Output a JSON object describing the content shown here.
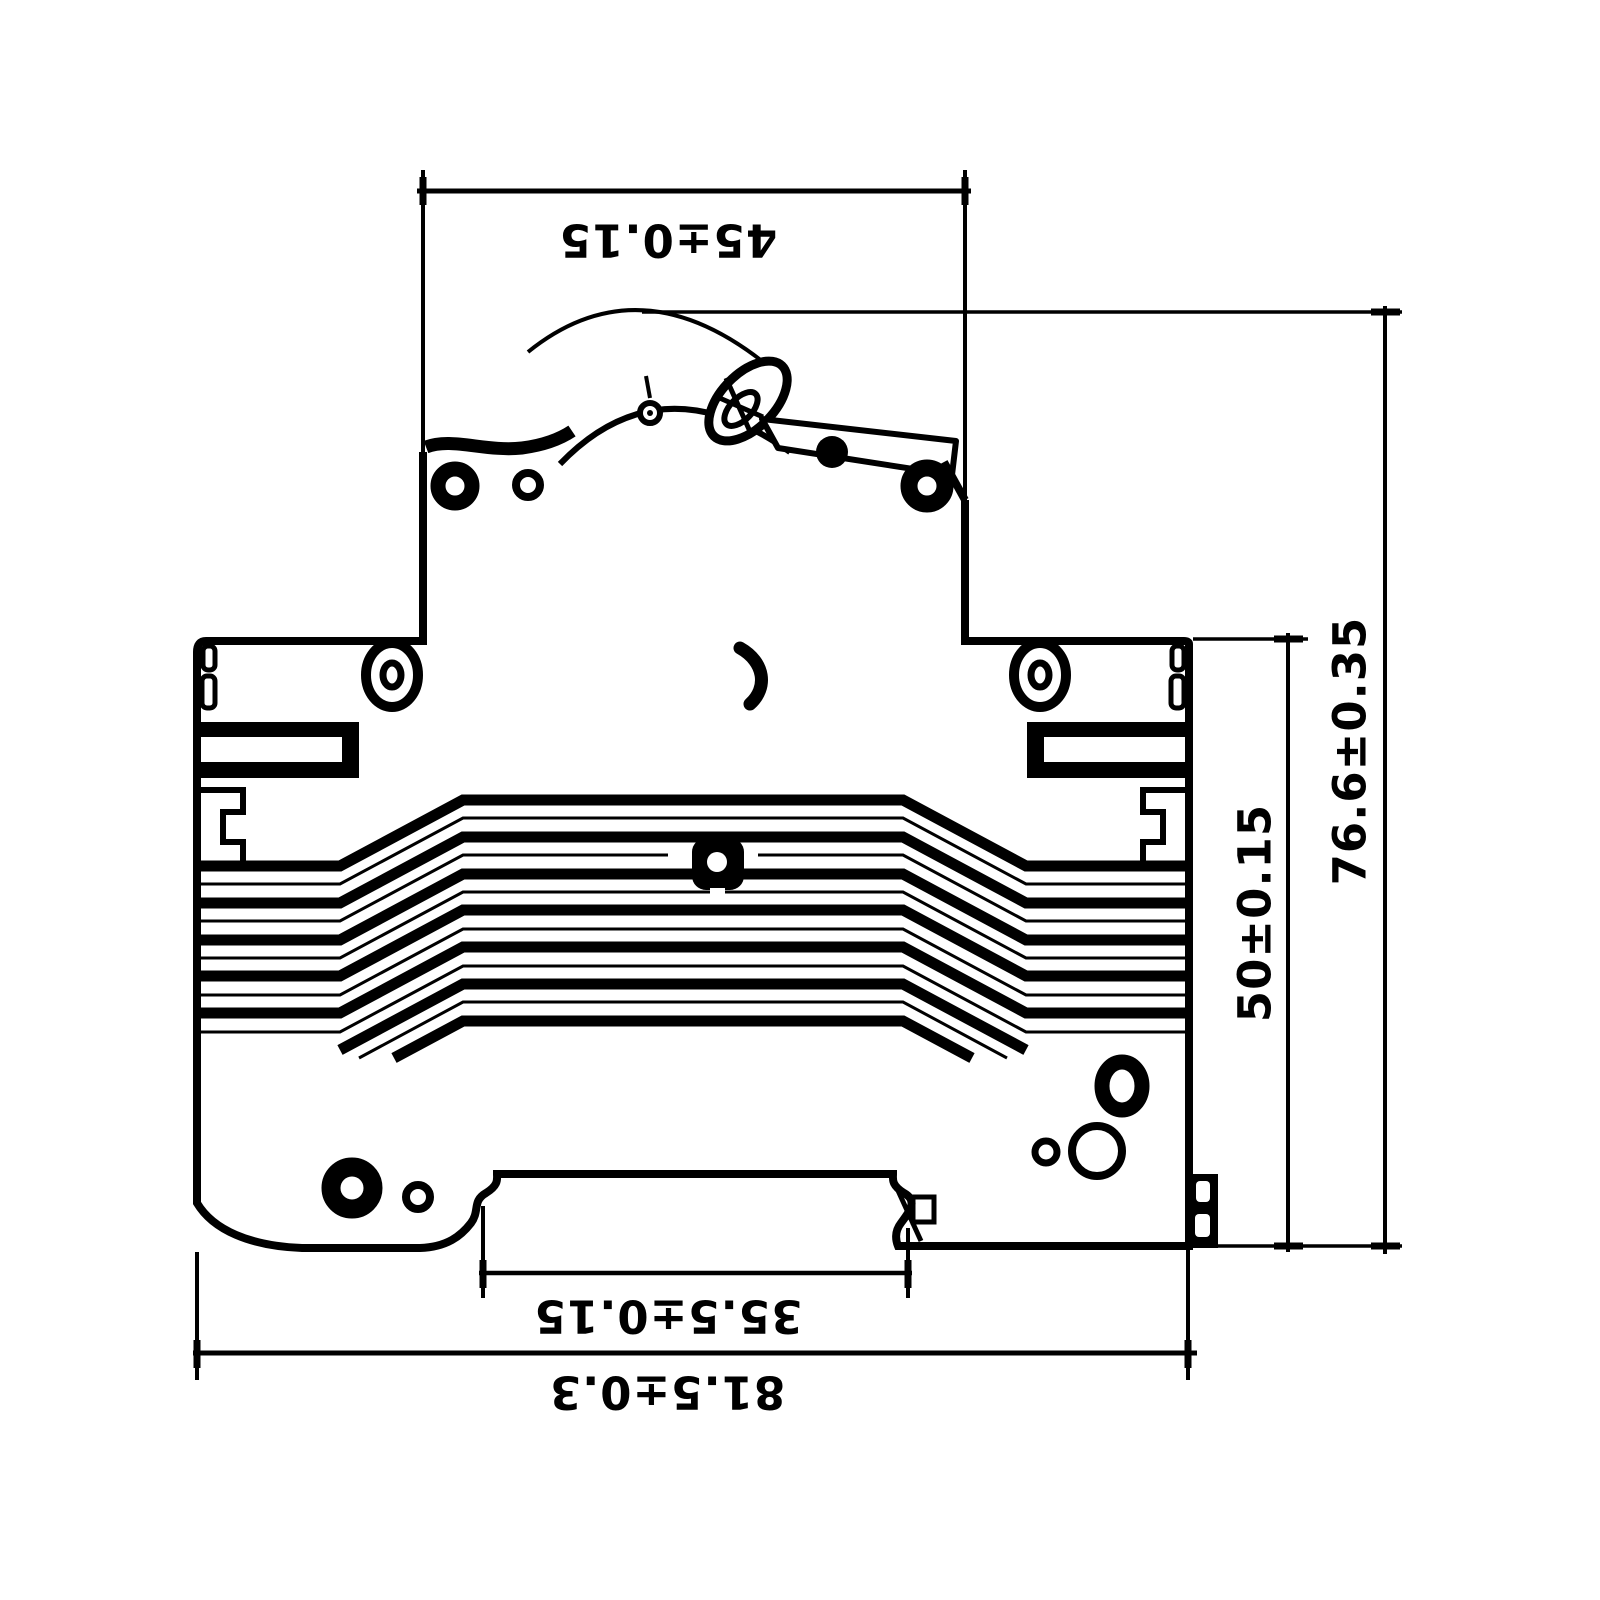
{
  "drawing": {
    "description": "Engineering drawing - DIN rail circuit breaker side profile with toleranced dimensions",
    "background_color": "#ffffff",
    "line_color": "#000000",
    "dimensions": {
      "top_width": "45±0.15",
      "overall_height": "76.6±0.35",
      "body_height": "50±0.15",
      "din_slot_width": "35.5±0.15",
      "overall_width": "81.5±0.3"
    }
  }
}
